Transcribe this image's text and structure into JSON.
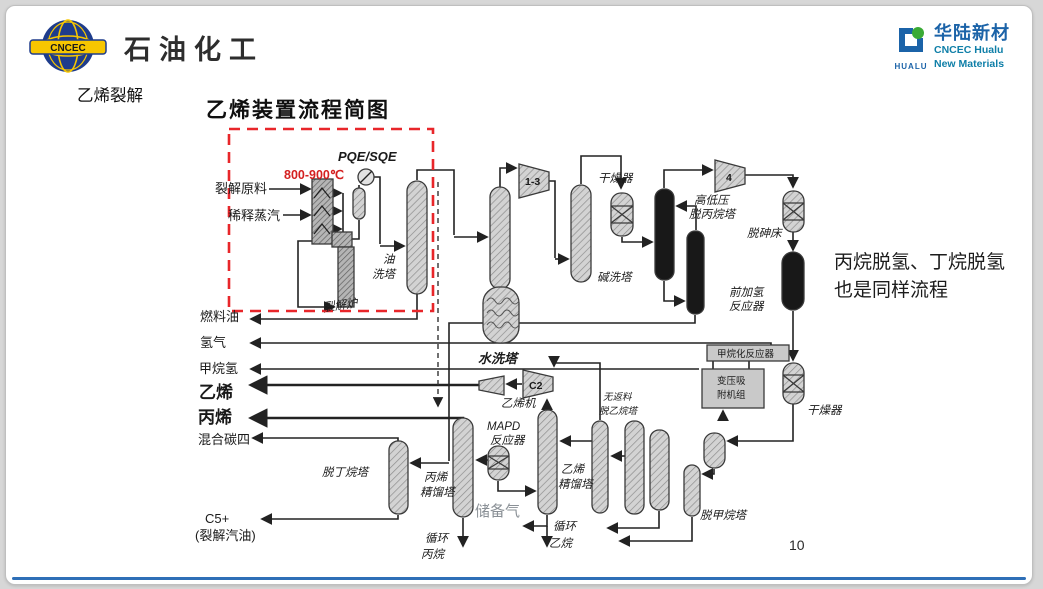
{
  "page": {
    "background": "#d7d7d7",
    "slide_background": "#ffffff",
    "bottom_line_color": "#2e6fb7"
  },
  "header": {
    "cncec_logo": {
      "text": "CNCEC",
      "globe_color": "#1e3c8c",
      "accent_color": "#f7c600"
    },
    "brand": "石油化工",
    "section_label": "乙烯裂解",
    "diagram_title": "乙烯装置流程简图",
    "hualu_logo": {
      "acronym": "HUALU",
      "name_cn": "华陆新材",
      "name_en_1": "CNCEC Hualu",
      "name_en_2": "New Materials",
      "blue": "#1b63a8",
      "teal": "#0f7fa8",
      "green": "#3aaa35"
    }
  },
  "side_note": {
    "line1": "丙烷脱氢、丁烷脱氢",
    "line2": "也是同样流程"
  },
  "page_number": "10",
  "diagram": {
    "red_box_color": "#e8262a",
    "temperature": "800-900℃",
    "labels": {
      "pqe": "PQE/SQE",
      "feed1": "裂解原料",
      "feed2": "稀释蒸汽",
      "furnace": "裂解炉",
      "oil_wash_1": "油",
      "oil_wash_2": "洗塔",
      "water_wash": "水洗塔",
      "comp13": "1-3",
      "caustic": "碱洗塔",
      "dryer1": "干燥器",
      "comp4": "4",
      "deprop1": "高低压",
      "deprop2": "脱丙烷塔",
      "arsenic": "脱砷床",
      "fronthydro1": "前加氢",
      "fronthydro2": "反应器",
      "methanation": "甲烷化反应器",
      "psa1": "变压吸",
      "psa2": "附机组",
      "dryer2": "干燥器",
      "demethanizer": "脱甲烷塔",
      "deeth1": "无返料",
      "deeth2": "脱乙烷塔",
      "e2frac1": "乙烯",
      "e2frac2": "精馏塔",
      "recycle_ethane1": "循环",
      "recycle_ethane2": "乙烷",
      "mapd1": "MAPD",
      "mapd2": "反应器",
      "reserve_gas": "储备气",
      "c3frac1": "丙烯",
      "c3frac2": "精馏塔",
      "recycle_propane1": "循环",
      "recycle_propane2": "丙烷",
      "debutanizer": "脱丁烷塔",
      "ethylene_comp": "乙烯机",
      "c2": "C2",
      "fuel_oil": "燃料油",
      "hydrogen": "氢气",
      "methane_h2": "甲烷氢",
      "ethylene": "乙烯",
      "propylene": "丙烯",
      "mixed_c4": "混合碳四",
      "c5": "C5+",
      "pygas": "(裂解汽油)"
    }
  }
}
